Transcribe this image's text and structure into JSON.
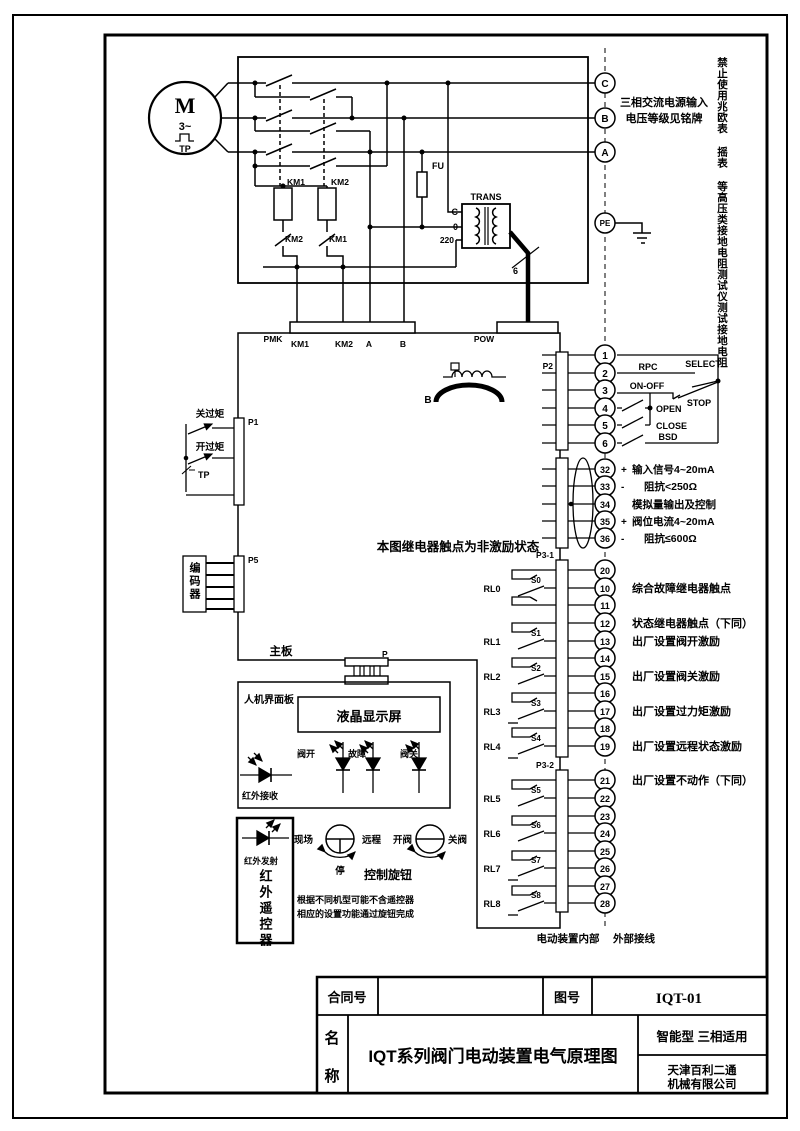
{
  "power": {
    "motor_m": "M",
    "motor_ph": "3~",
    "motor_tp": "TP",
    "km1": "KM1",
    "km2": "KM2",
    "nc_km2": "KM2",
    "nc_km1": "KM1",
    "fu": "FU",
    "trans": "TRANS",
    "tap_c": "C",
    "tap_0": "0",
    "tap_220": "220",
    "six": "6"
  },
  "phases": {
    "c": "C",
    "b": "B",
    "a": "A",
    "pe": "PE",
    "note1": "三相交流电源输入",
    "note2": "电压等级见铭牌",
    "warning": "禁止使用兆欧表 摇表 等高压类接地电阻测试仪测试接地电阻"
  },
  "conn": {
    "pmk": "PMK",
    "km1": "KM1",
    "km2": "KM2",
    "a": "A",
    "b": "B",
    "pow": "POW",
    "p1": "P1",
    "p2": "P2",
    "p4": "P4",
    "p5": "P5",
    "p": "P",
    "p31": "P3-1",
    "p32": "P3-2",
    "ind_b": "B"
  },
  "p2": {
    "terminals": [
      "1",
      "2",
      "3",
      "4",
      "5",
      "6"
    ],
    "rpc": "RPC",
    "select": "SELECT",
    "onoff": "ON-OFF",
    "stop": "STOP",
    "open": "OPEN",
    "close": "CLOSE",
    "bsd": "BSD"
  },
  "p4": {
    "terminals": [
      "32",
      "33",
      "34",
      "35",
      "36"
    ],
    "signs": [
      "+",
      "-",
      "+",
      "-"
    ],
    "labels": [
      "输入信号4~20mA",
      "阻抗<250Ω",
      "模拟量输出及控制",
      "阀位电流4~20mA",
      "阻抗≤600Ω"
    ]
  },
  "note_relay": "本图继电器触点为非激励状态",
  "p31": {
    "terminals": [
      "20",
      "10",
      "11",
      "12",
      "13",
      "14",
      "15",
      "16",
      "17",
      "18",
      "19"
    ],
    "relays": [
      "RL0",
      "RL1",
      "RL2",
      "RL3",
      "RL4"
    ],
    "switches": [
      "S0",
      "S1",
      "S2",
      "S3",
      "S4"
    ],
    "l10": "综合故障继电器触点",
    "l12": "状态继电器触点（下同）",
    "l13": "出厂设置阀开激励",
    "l15": "出厂设置阀关激励",
    "l17": "出厂设置过力矩激励",
    "l19": "出厂设置远程状态激励"
  },
  "p32": {
    "terminals": [
      "21",
      "22",
      "23",
      "24",
      "25",
      "26",
      "27",
      "28"
    ],
    "relays": [
      "RL5",
      "RL6",
      "RL7",
      "RL8"
    ],
    "switches": [
      "S5",
      "S6",
      "S7",
      "S8"
    ],
    "l21": "出厂设置不动作（下同）"
  },
  "left": {
    "close_torque": "关过矩",
    "open_torque": "开过矩",
    "tp": "TP",
    "encoder": "编码器",
    "mainboard": "主板"
  },
  "hmi": {
    "panel": "人机界面板",
    "lcd": "液晶显示屏",
    "led_open": "阀开",
    "led_fault": "故障",
    "led_close": "阀关",
    "ir_rx": "红外接收"
  },
  "remote": {
    "ir_tx": "红外发射",
    "name": "红外遥控器",
    "local": "现场",
    "remote": "远程",
    "stop": "停",
    "open_valve": "开阀",
    "close_valve": "关阀",
    "knob": "控制旋钮",
    "note1": "根据不同机型可能不含遥控器",
    "note2": "相应的设置功能通过旋钮完成"
  },
  "bottom": {
    "internal": "电动装置内部",
    "external": "外部接线"
  },
  "tb": {
    "contract": "合同号",
    "drawing_no": "图号",
    "drawing_no_value": "IQT-01",
    "name1": "名",
    "name2": "称",
    "title": "IQT系列阀门电动装置电气原理图",
    "type_note": "智能型  三相适用",
    "company1": "天津百利二通",
    "company2": "机械有限公司"
  }
}
